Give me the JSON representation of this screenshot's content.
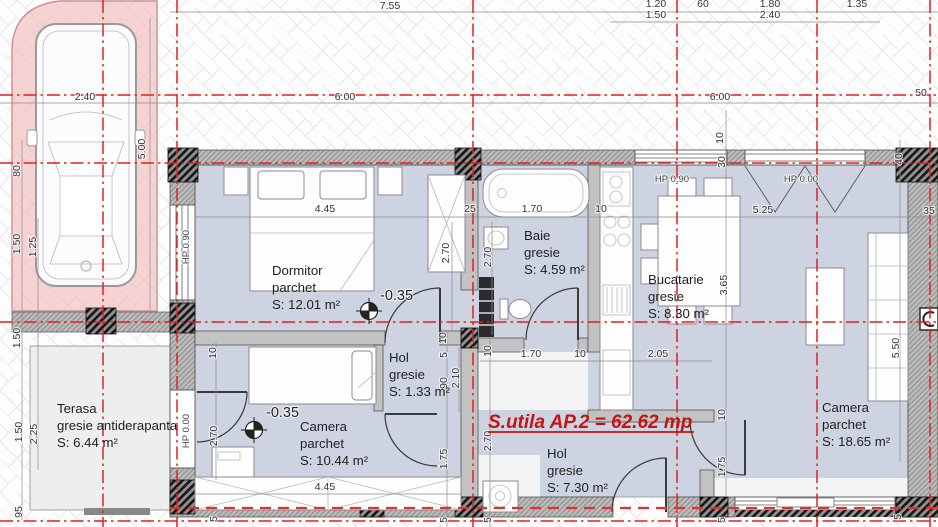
{
  "plan": {
    "title": "S.utila AP.2 = 62.62 mp",
    "colors": {
      "axis_red": "#e02020",
      "title_red": "#c41414",
      "floor_blue": "#cdd3e0",
      "terrace_gray": "#ecefee",
      "parking_pink": "#f4c9c6",
      "dim_text": "#333333"
    },
    "rooms": [
      {
        "id": "dormitor",
        "name": "Dormitor",
        "finish": "parchet",
        "area": "S: 12.01 m²",
        "x": 272,
        "y": 275
      },
      {
        "id": "baie",
        "name": "Baie",
        "finish": "gresie",
        "area": "S: 4.59 m²",
        "x": 524,
        "y": 240
      },
      {
        "id": "bucatarie",
        "name": "Bucatarie",
        "finish": "gresie",
        "area": "S: 8.30 m²",
        "x": 648,
        "y": 284
      },
      {
        "id": "hol-mic",
        "name": "Hol",
        "finish": "gresie",
        "area": "S: 1.33 m²",
        "x": 389,
        "y": 362
      },
      {
        "id": "camera-mica",
        "name": "Camera",
        "finish": "parchet",
        "area": "S: 10.44 m²",
        "x": 300,
        "y": 431
      },
      {
        "id": "hol",
        "name": "Hol",
        "finish": "gresie",
        "area": "S: 7.30 m²",
        "x": 547,
        "y": 458
      },
      {
        "id": "camera-mare",
        "name": "Camera",
        "finish": "parchet",
        "area": "S: 18.65 m²",
        "x": 822,
        "y": 412
      },
      {
        "id": "terasa",
        "name": "Terasa",
        "finish": "gresie antiderapanta",
        "area": "S: 6.44 m²",
        "x": 57,
        "y": 413
      }
    ],
    "levels": [
      {
        "text": "-0.35",
        "tx": 380,
        "ty": 300,
        "mx": 369,
        "my": 311
      },
      {
        "text": "-0.35",
        "tx": 266,
        "ty": 417,
        "mx": 254,
        "my": 430
      }
    ],
    "parapet_labels": [
      {
        "text": "HP 0.90",
        "x": 189,
        "y": 247,
        "rot": true
      },
      {
        "text": "HP 0.90",
        "x": 672,
        "y": 182,
        "rot": false
      },
      {
        "text": "HP 0.00",
        "x": 801,
        "y": 182,
        "rot": false
      },
      {
        "text": "HP 0.00",
        "x": 189,
        "y": 431,
        "rot": true
      }
    ],
    "dimensions": [
      {
        "t": "7.55",
        "x": 390,
        "y": 9
      },
      {
        "t": "1.20",
        "x": 656,
        "y": 7
      },
      {
        "t": "60",
        "x": 703,
        "y": 7
      },
      {
        "t": "1.80",
        "x": 770,
        "y": 7
      },
      {
        "t": "1.35",
        "x": 857,
        "y": 7
      },
      {
        "t": "1.50",
        "x": 656,
        "y": 18
      },
      {
        "t": "2.40",
        "x": 770,
        "y": 18
      },
      {
        "t": "2.40",
        "x": 85,
        "y": 100
      },
      {
        "t": "6.00",
        "x": 345,
        "y": 100
      },
      {
        "t": "6.00",
        "x": 720,
        "y": 100
      },
      {
        "t": "50",
        "x": 921,
        "y": 96
      },
      {
        "t": "4.45",
        "x": 325,
        "y": 212
      },
      {
        "t": "25",
        "x": 470,
        "y": 212
      },
      {
        "t": "1.70",
        "x": 532,
        "y": 212
      },
      {
        "t": "10",
        "x": 601,
        "y": 212
      },
      {
        "t": "5.25",
        "x": 763,
        "y": 213
      },
      {
        "t": "35",
        "x": 929,
        "y": 214
      },
      {
        "t": "1.70",
        "x": 531,
        "y": 357
      },
      {
        "t": "10",
        "x": 580,
        "y": 357
      },
      {
        "t": "2.05",
        "x": 658,
        "y": 357
      },
      {
        "t": "4.45",
        "x": 325,
        "y": 490
      },
      {
        "t": "80",
        "x": 20,
        "y": 171,
        "r": 1
      },
      {
        "t": "1.50",
        "x": 20,
        "y": 244,
        "r": 1
      },
      {
        "t": "1.25",
        "x": 36,
        "y": 247,
        "r": 1
      },
      {
        "t": "5.00",
        "x": 145,
        "y": 149,
        "r": 1
      },
      {
        "t": "1.50",
        "x": 20,
        "y": 338,
        "r": 1
      },
      {
        "t": "1.50",
        "x": 22,
        "y": 432,
        "r": 1
      },
      {
        "t": "2.25",
        "x": 37,
        "y": 434,
        "r": 1
      },
      {
        "t": "95",
        "x": 22,
        "y": 512,
        "r": 1
      },
      {
        "t": "2.70",
        "x": 449,
        "y": 253,
        "r": 1
      },
      {
        "t": "2.70",
        "x": 491,
        "y": 257,
        "r": 1
      },
      {
        "t": "10",
        "x": 723,
        "y": 138,
        "r": 1
      },
      {
        "t": "30",
        "x": 725,
        "y": 162,
        "r": 1
      },
      {
        "t": "40",
        "x": 902,
        "y": 159,
        "r": 1
      },
      {
        "t": "3.65",
        "x": 727,
        "y": 285,
        "r": 1
      },
      {
        "t": "5.50",
        "x": 899,
        "y": 348,
        "r": 1
      },
      {
        "t": "10",
        "x": 446,
        "y": 338,
        "r": 1
      },
      {
        "t": "5",
        "x": 447,
        "y": 355,
        "r": 1
      },
      {
        "t": "90",
        "x": 447,
        "y": 383,
        "r": 1
      },
      {
        "t": "2.10",
        "x": 459,
        "y": 378,
        "r": 1
      },
      {
        "t": "1.75",
        "x": 447,
        "y": 459,
        "r": 1
      },
      {
        "t": "2.70",
        "x": 491,
        "y": 441,
        "r": 1
      },
      {
        "t": "10",
        "x": 491,
        "y": 351,
        "r": 1
      },
      {
        "t": "10",
        "x": 725,
        "y": 415,
        "r": 1
      },
      {
        "t": "1.75",
        "x": 725,
        "y": 467,
        "r": 1
      },
      {
        "t": "10",
        "x": 216,
        "y": 353,
        "r": 1
      },
      {
        "t": "2.70",
        "x": 217,
        "y": 436,
        "r": 1
      },
      {
        "t": "5",
        "x": 447,
        "y": 520,
        "r": 1
      },
      {
        "t": "5",
        "x": 491,
        "y": 520,
        "r": 1
      },
      {
        "t": "5",
        "x": 725,
        "y": 520,
        "r": 1
      },
      {
        "t": "5",
        "x": 217,
        "y": 519,
        "r": 1
      },
      {
        "t": "5",
        "x": 901,
        "y": 517,
        "r": 1
      }
    ],
    "axes": {
      "vertical": [
        103,
        177,
        473,
        677,
        817,
        930
      ],
      "horizontal": [
        95,
        163,
        322,
        521
      ],
      "entry": {
        "y": 508,
        "x1": 170,
        "x2": 938
      }
    }
  }
}
